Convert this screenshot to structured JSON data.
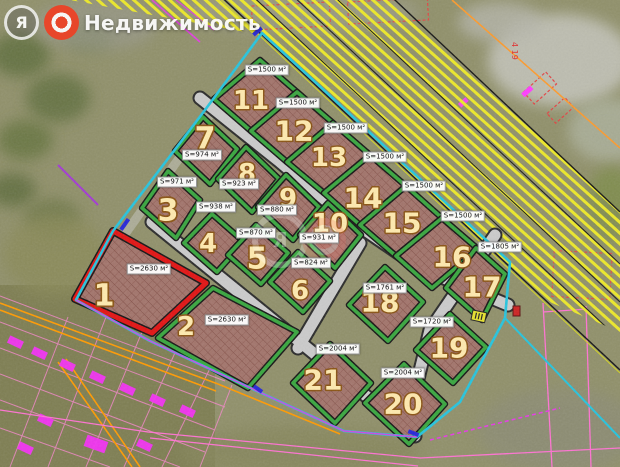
{
  "watermark": {
    "logo_letter": "Я",
    "brand": "Недвижимость"
  },
  "map": {
    "selected_plot": "1",
    "area_unit": "м²",
    "plots": [
      {
        "n": "1",
        "area": "S=2630 м²",
        "selected": true
      },
      {
        "n": "2",
        "area": "S=2630 м²",
        "selected": false
      },
      {
        "n": "3",
        "area": "S=971 м²",
        "selected": false
      },
      {
        "n": "4",
        "area": "S=938 м²",
        "selected": false
      },
      {
        "n": "5",
        "area": "S=870 м²",
        "selected": false
      },
      {
        "n": "6",
        "area": "S=824 м²",
        "selected": false
      },
      {
        "n": "7",
        "area": "S=974 м²",
        "selected": false
      },
      {
        "n": "8",
        "area": "S=923 м²",
        "selected": false
      },
      {
        "n": "9",
        "area": "S=880 м²",
        "selected": false
      },
      {
        "n": "10",
        "area": "S=931 м²",
        "selected": false
      },
      {
        "n": "11",
        "area": "S=1500 м²",
        "selected": false
      },
      {
        "n": "12",
        "area": "S=1500 м²",
        "selected": false
      },
      {
        "n": "13",
        "area": "S=1500 м²",
        "selected": false
      },
      {
        "n": "14",
        "area": "S=1500 м²",
        "selected": false
      },
      {
        "n": "15",
        "area": "S=1500 м²",
        "selected": false
      },
      {
        "n": "16",
        "area": "S=1500 м²",
        "selected": false
      },
      {
        "n": "17",
        "area": "S=1805 м²",
        "selected": false
      },
      {
        "n": "18",
        "area": "S=1761 м²",
        "selected": false
      },
      {
        "n": "19",
        "area": "S=1720 м²",
        "selected": false
      },
      {
        "n": "20",
        "area": "S=2004 м²",
        "selected": false
      },
      {
        "n": "21",
        "area": "S=2004 м²",
        "selected": false
      }
    ],
    "markers": {
      "topright_red_text": "4 19"
    },
    "colors": {
      "selected_outline": "#e21212",
      "plot_border": "#38a63e",
      "site_boundary": "#25c4de",
      "corridor_hatch": "#ece829",
      "road": "#cbcbcb",
      "number_text": "#ffeaae",
      "number_outline": "#8a5313"
    }
  }
}
